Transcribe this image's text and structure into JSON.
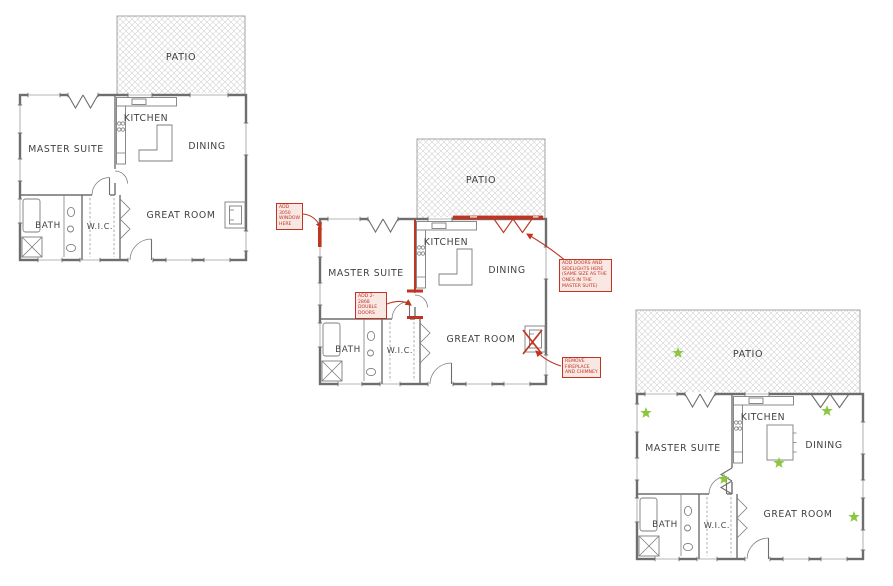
{
  "canvas": {
    "width": 893,
    "height": 586,
    "background": "#ffffff"
  },
  "rooms": {
    "patio": "PATIO",
    "kitchen": "KITCHEN",
    "dining": "DINING",
    "master_suite": "MASTER SUITE",
    "bath": "BATH",
    "wic": "W.I.C.",
    "great_room": "GREAT ROOM"
  },
  "plans": {
    "original": {},
    "annotated": {
      "annotations": {
        "add_window": "ADD 3050 WINDOW HERE",
        "add_double_doors": "ADD 2-2868 DOUBLE DOORS",
        "add_doors_sidelights": "ADD DOORS AND SIDELIGHTS HERE (SAME SIZE AS THE ONES IN THE MASTER SUITE)",
        "remove_fireplace": "REMOVE FIREPLACE AND CHIMNEY"
      }
    },
    "revised": {
      "star_glyph": "★",
      "star_count": 6,
      "stars": [
        {
          "location": "patio-extension"
        },
        {
          "location": "new-master-window"
        },
        {
          "location": "new-dining-doors"
        },
        {
          "location": "new-kitchen-island"
        },
        {
          "location": "new-master-double-doors"
        },
        {
          "location": "removed-fireplace-wall"
        }
      ]
    }
  },
  "colors": {
    "wall": "#6e6e6e",
    "patio_hatch": "#d0d0d0",
    "label_text": "#414141",
    "markup_red": "#bf3522",
    "star_green": "#8cc63f"
  }
}
